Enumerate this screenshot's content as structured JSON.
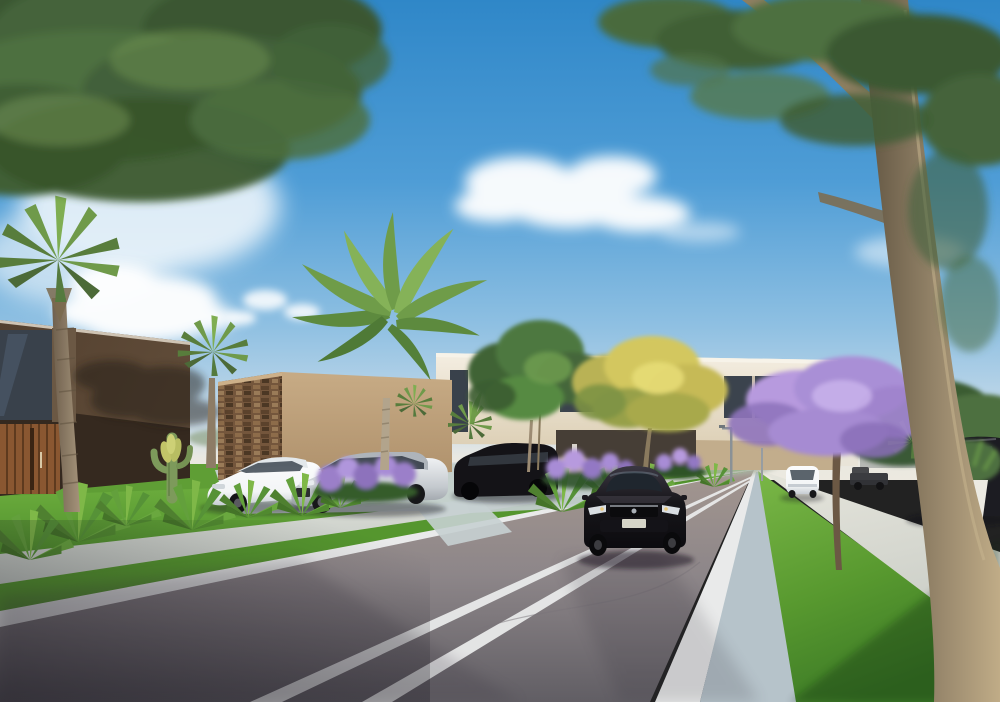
{
  "meta": {
    "title": "Residential street architectural rendering",
    "type": "photorealistic 3D exterior visualization",
    "time_of_day": "clear sunny afternoon, blue sky with scattered clouds",
    "description": "Modern suburban street scene: dark-brown and cream contemporary two-story houses on the left with a stone accent wall, palm trees and a tall royal palm, agave and lavender landscaping, parked cars in driveways, a dark sedan driving toward the viewer on an asphalt road with double white lane lines, a jacaranda tree and yellow-flowering tree, wide concrete sidewalks, bright lawns, and a large foreground tree trunk on the right."
  },
  "palette": {
    "sky_top": "#2f87c8",
    "sky_mid": "#4f9dd6",
    "sky_low": "#8fc0e2",
    "sky_pale": "#c9dcea",
    "sky_horizon": "#e6e8e4",
    "cloud": "#ffffff",
    "haze": "#ece9e0",
    "canopy_dark": "#3a5730",
    "canopy_mid": "#4d7040",
    "canopy_light": "#6f9150",
    "palm_frond": "#6f9a4a",
    "palm_trunk": "#a5937a",
    "trunk_brown": "#9b8a6e",
    "trunk_shade": "#5f5340",
    "jacaranda_purple": "#a98fd6",
    "lavender_purple": "#9b7fc9",
    "yellow_bloom": "#d3c75e",
    "grass_bright": "#72b341",
    "grass_mid": "#4f8f2c",
    "grass_shade": "#3c7a26",
    "road_far": "#a3968f",
    "road_asphalt": "#8d8689",
    "road_shadow": "#615e64",
    "lane_white": "#e9eaea",
    "sidewalk": "#d6d9d2",
    "gutter": "#b6c3ca",
    "house_left_dark": "#53402f",
    "house_left_deep": "#35291f",
    "wood_door": "#8a5731",
    "stone_wall": "#74563c",
    "tan_wall": "#c7ab85",
    "cream_house": "#ece4d2",
    "window_dark": "#39414b",
    "car_white": "#f3f5f6",
    "car_silver": "#c4c9ce",
    "car_black": "#17161a",
    "planter_white": "#eceae2"
  },
  "scene": {
    "objects": [
      {
        "name": "sky",
        "desc": "blue gradient sky fading to pale horizon"
      },
      {
        "name": "clouds",
        "desc": "white cumulus clusters left and center"
      },
      {
        "name": "canopy-top-left",
        "desc": "dense dark-green overhanging tree canopy"
      },
      {
        "name": "canopy-top-right",
        "desc": "feathery foliage and thick tan branch"
      },
      {
        "name": "fan-palm-large",
        "desc": "fan palm with curved trunk in front of left house"
      },
      {
        "name": "fan-palm-small",
        "desc": "small fan palm between houses"
      },
      {
        "name": "royal-palm",
        "desc": "tall royal palm over the cream house"
      },
      {
        "name": "house-left",
        "desc": "dark brown modern two-story house with glass corner window and wood slat entry"
      },
      {
        "name": "stone-accent-wall",
        "desc": "brown mosaic stone feature wall"
      },
      {
        "name": "perimeter-wall",
        "desc": "tan stucco street wall"
      },
      {
        "name": "house-middle",
        "desc": "cream two-story house with dark ribbon windows"
      },
      {
        "name": "carport-shade",
        "desc": "dark recessed carport behind driving sedan"
      },
      {
        "name": "cactus",
        "desc": "green columnar cactus with arms"
      },
      {
        "name": "agave-plants",
        "desc": "row of spiky agaves along the lawn"
      },
      {
        "name": "lavender-shrubs",
        "desc": "purple flowering shrubs in front of parked cars"
      },
      {
        "name": "street-tree-green",
        "desc": "green round-canopy street tree"
      },
      {
        "name": "street-tree-yellow",
        "desc": "yellow flowering tree"
      },
      {
        "name": "jacaranda-tree",
        "desc": "purple jacaranda on right median"
      },
      {
        "name": "foreground-tree",
        "desc": "large tree trunk at right edge"
      },
      {
        "name": "car-white-coupe",
        "desc": "white coupe parked nose-out"
      },
      {
        "name": "car-silver-sedan",
        "desc": "silver sedan parked nose-out"
      },
      {
        "name": "car-suv-driveway",
        "desc": "black SUV parked in shaded driveway"
      },
      {
        "name": "car-black-sedan",
        "desc": "dark sedan driving toward viewer"
      },
      {
        "name": "car-white-distant",
        "desc": "white car driving away"
      },
      {
        "name": "truck-distant",
        "desc": "dark pickup parked in distance"
      },
      {
        "name": "car-suv-right",
        "desc": "dark SUV parked on right"
      },
      {
        "name": "planter-pot",
        "desc": "white planter with green plant"
      },
      {
        "name": "street-lamps",
        "desc": "thin distant street light poles"
      },
      {
        "name": "road",
        "desc": "asphalt road with double white center lines and edge lines"
      },
      {
        "name": "sidewalks",
        "desc": "concrete sidewalks both sides"
      },
      {
        "name": "lawns",
        "desc": "bright green grass strips"
      },
      {
        "name": "distant-buildings",
        "desc": "hazy gray and dark buildings at street end"
      }
    ]
  }
}
